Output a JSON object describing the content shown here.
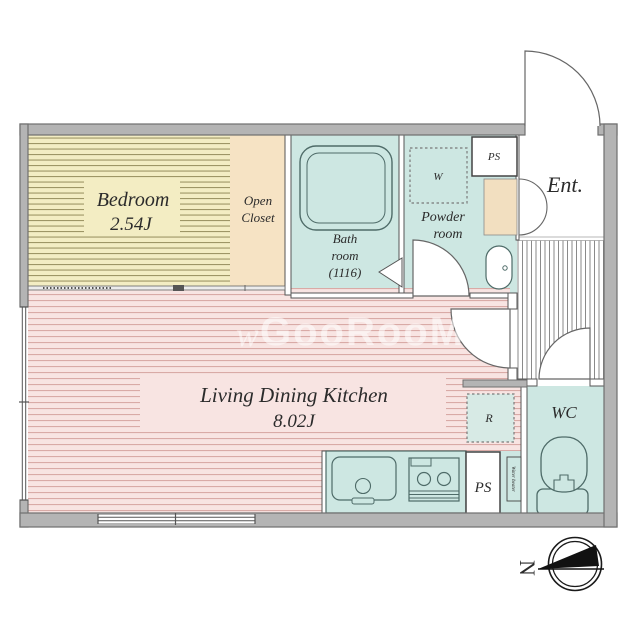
{
  "plan_title": "1K apartment floor plan",
  "watermark": {
    "mark": "w",
    "text": "GooRooM"
  },
  "rooms": {
    "bedroom": {
      "name": "Bedroom",
      "size": "2.54J"
    },
    "open_closet": {
      "line1": "Open",
      "line2": "Closet"
    },
    "bath": {
      "line1": "Bath",
      "line2": "room",
      "line3": "(1116)"
    },
    "powder": {
      "line1": "Powder",
      "line2": "room"
    },
    "entrance": {
      "label": "Ent."
    },
    "ldk": {
      "name": "Living Dining Kitchen",
      "size": "8.02J"
    },
    "wc": {
      "label": "WC"
    }
  },
  "fixtures": {
    "ps_top": "PS",
    "ps_bottom": "PS",
    "washer": "W",
    "fridge": "R",
    "water_heater": "Water heater"
  },
  "compass": {
    "north_label": "N"
  },
  "colors": {
    "wall_fill": "#b4b4b4",
    "wall_edge": "#6f6f6f",
    "bedroom_fill": "#f3edc3",
    "bedroom_stripe": "#9e9666",
    "closet_fill": "#f6e3c4",
    "ldk_fill": "#f8e4e2",
    "ldk_stripe": "#d9aaa6",
    "wet_area_fill": "#cde7e2",
    "cabinet_fill": "#f2dfc0",
    "line_color": "#555555"
  }
}
